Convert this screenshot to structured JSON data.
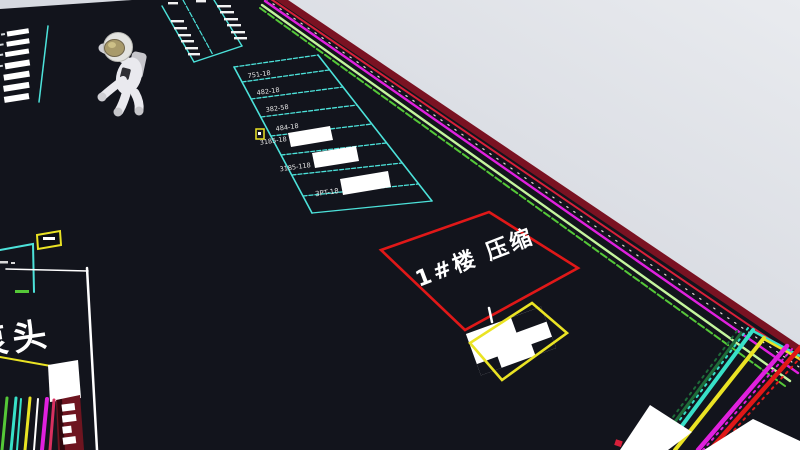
{
  "colors": {
    "sky_left": "#c3c7d1",
    "sky_right": "#e9ebef",
    "ground": "#12141c",
    "cyan": "#4ce2da",
    "red": "#e01818",
    "yellow": "#eae324",
    "magenta": "#e020de",
    "green": "#55c838",
    "pale_green": "#c4f59d",
    "dark_green": "#1d6b38",
    "teal": "#38e0c8",
    "crimson_band": "#7a1222",
    "bright_crimson": "#d8203a",
    "maroon_panel": "#6e1520",
    "pink": "#d83060",
    "white": "#ffffff",
    "suit": "#e9e9ee",
    "visor": "#a89a6a",
    "pack": "#c6c6cb"
  },
  "cad": {
    "room_label": "1#楼 压缩",
    "pump_label": "泵头",
    "stall_labels": [
      "751-18",
      "482-18",
      "382-58",
      "484-18",
      "3185-18",
      "3185-118",
      "3PT-18"
    ]
  }
}
